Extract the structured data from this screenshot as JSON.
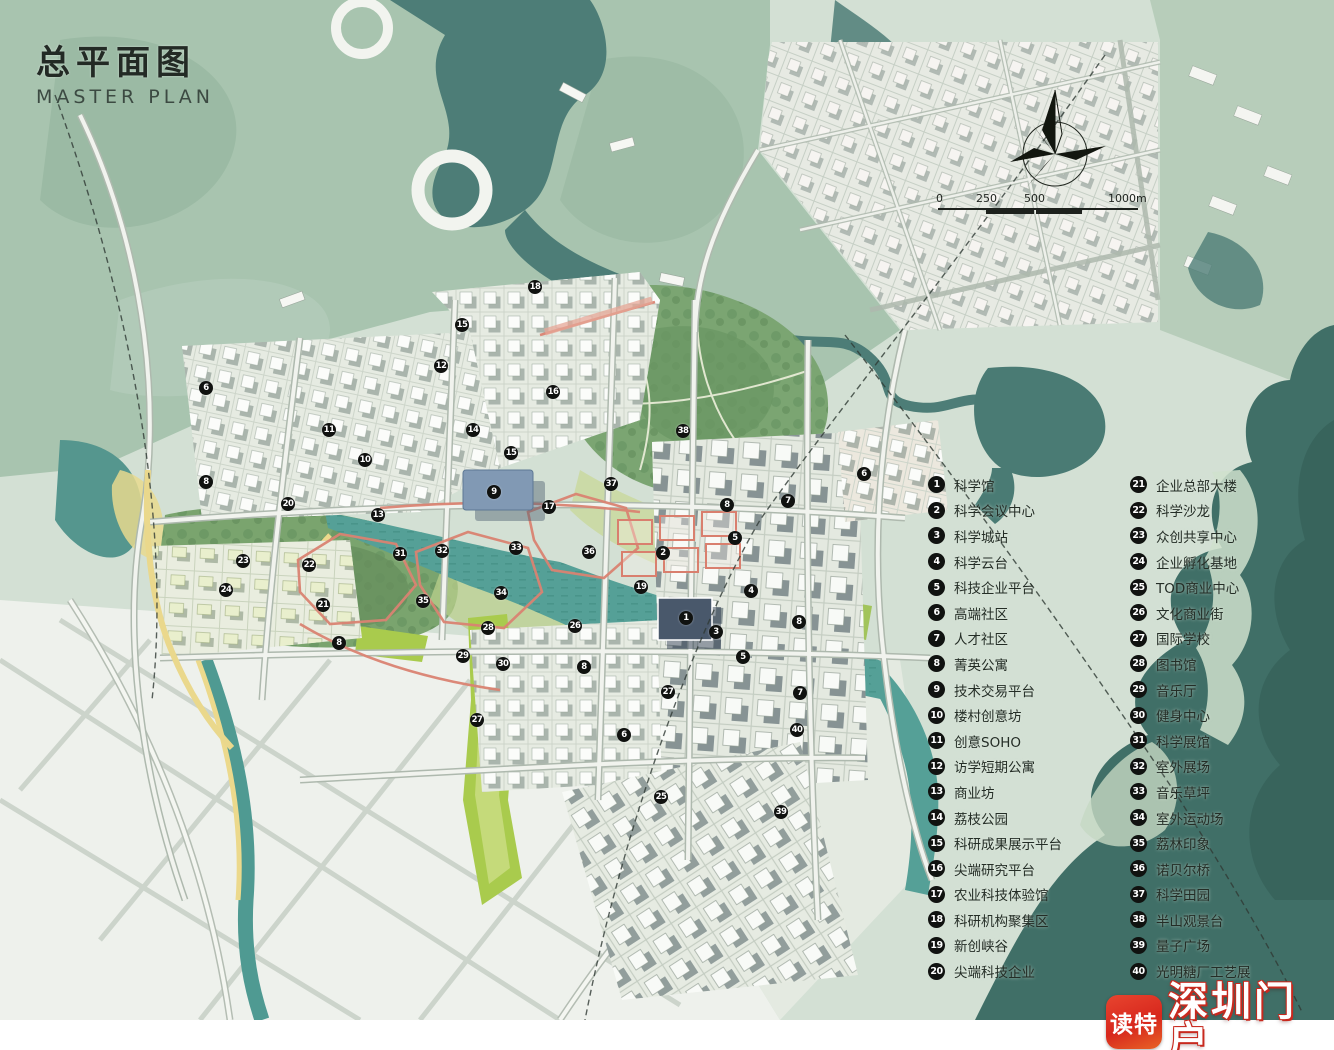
{
  "title": {
    "zh": "总平面图",
    "en": "MASTER PLAN"
  },
  "scale_bar": {
    "ticks": [
      "0",
      "250",
      "500",
      "1000m"
    ]
  },
  "legend": {
    "col1": [
      {
        "num": "1",
        "label": "科学馆"
      },
      {
        "num": "2",
        "label": "科学会议中心"
      },
      {
        "num": "3",
        "label": "科学城站"
      },
      {
        "num": "4",
        "label": "科学云台"
      },
      {
        "num": "5",
        "label": "科技企业平台"
      },
      {
        "num": "6",
        "label": "高端社区"
      },
      {
        "num": "7",
        "label": "人才社区"
      },
      {
        "num": "8",
        "label": "菁英公寓"
      },
      {
        "num": "9",
        "label": "技术交易平台"
      },
      {
        "num": "10",
        "label": "楼村创意坊"
      },
      {
        "num": "11",
        "label": "创意SOHO"
      },
      {
        "num": "12",
        "label": "访学短期公寓"
      },
      {
        "num": "13",
        "label": "商业坊"
      },
      {
        "num": "14",
        "label": "荔枝公园"
      },
      {
        "num": "15",
        "label": "科研成果展示平台"
      },
      {
        "num": "16",
        "label": "尖端研究平台"
      },
      {
        "num": "17",
        "label": "农业科技体验馆"
      },
      {
        "num": "18",
        "label": "科研机构聚集区"
      },
      {
        "num": "19",
        "label": "新创峡谷"
      },
      {
        "num": "20",
        "label": "尖端科技企业"
      }
    ],
    "col2": [
      {
        "num": "21",
        "label": "企业总部大楼"
      },
      {
        "num": "22",
        "label": "科学沙龙"
      },
      {
        "num": "23",
        "label": "众创共享中心"
      },
      {
        "num": "24",
        "label": "企业孵化基地"
      },
      {
        "num": "25",
        "label": "TOD商业中心"
      },
      {
        "num": "26",
        "label": "文化商业街"
      },
      {
        "num": "27",
        "label": "国际学校"
      },
      {
        "num": "28",
        "label": "图书馆"
      },
      {
        "num": "29",
        "label": "音乐厅"
      },
      {
        "num": "30",
        "label": "健身中心"
      },
      {
        "num": "31",
        "label": "科学展馆"
      },
      {
        "num": "32",
        "label": "室外展场"
      },
      {
        "num": "33",
        "label": "音乐草坪"
      },
      {
        "num": "34",
        "label": "室外运动场"
      },
      {
        "num": "35",
        "label": "荔林印象"
      },
      {
        "num": "36",
        "label": "诺贝尔桥"
      },
      {
        "num": "37",
        "label": "科学田园"
      },
      {
        "num": "38",
        "label": "半山观景台"
      },
      {
        "num": "39",
        "label": "量子广场"
      },
      {
        "num": "40",
        "label": "光明糖厂工艺展"
      }
    ]
  },
  "map_markers": [
    {
      "num": "18",
      "x": 535,
      "y": 287
    },
    {
      "num": "15",
      "x": 462,
      "y": 325
    },
    {
      "num": "12",
      "x": 441,
      "y": 366
    },
    {
      "num": "16",
      "x": 553,
      "y": 392
    },
    {
      "num": "6",
      "x": 206,
      "y": 388
    },
    {
      "num": "11",
      "x": 329,
      "y": 430
    },
    {
      "num": "14",
      "x": 473,
      "y": 430
    },
    {
      "num": "38",
      "x": 683,
      "y": 431
    },
    {
      "num": "15",
      "x": 511,
      "y": 453
    },
    {
      "num": "10",
      "x": 365,
      "y": 460
    },
    {
      "num": "8",
      "x": 206,
      "y": 482
    },
    {
      "num": "6",
      "x": 864,
      "y": 474
    },
    {
      "num": "9",
      "x": 494,
      "y": 492
    },
    {
      "num": "37",
      "x": 611,
      "y": 484
    },
    {
      "num": "7",
      "x": 788,
      "y": 501
    },
    {
      "num": "17",
      "x": 549,
      "y": 507
    },
    {
      "num": "8",
      "x": 727,
      "y": 505
    },
    {
      "num": "20",
      "x": 288,
      "y": 504
    },
    {
      "num": "13",
      "x": 378,
      "y": 515
    },
    {
      "num": "5",
      "x": 735,
      "y": 538
    },
    {
      "num": "33",
      "x": 516,
      "y": 548
    },
    {
      "num": "32",
      "x": 442,
      "y": 551
    },
    {
      "num": "31",
      "x": 400,
      "y": 554
    },
    {
      "num": "36",
      "x": 589,
      "y": 552
    },
    {
      "num": "2",
      "x": 663,
      "y": 553
    },
    {
      "num": "23",
      "x": 243,
      "y": 561
    },
    {
      "num": "22",
      "x": 309,
      "y": 565
    },
    {
      "num": "34",
      "x": 501,
      "y": 593
    },
    {
      "num": "4",
      "x": 751,
      "y": 591
    },
    {
      "num": "19",
      "x": 641,
      "y": 587
    },
    {
      "num": "24",
      "x": 226,
      "y": 590
    },
    {
      "num": "35",
      "x": 423,
      "y": 601
    },
    {
      "num": "21",
      "x": 323,
      "y": 605
    },
    {
      "num": "1",
      "x": 686,
      "y": 618
    },
    {
      "num": "8",
      "x": 799,
      "y": 622
    },
    {
      "num": "28",
      "x": 488,
      "y": 628
    },
    {
      "num": "26",
      "x": 575,
      "y": 626
    },
    {
      "num": "3",
      "x": 716,
      "y": 632
    },
    {
      "num": "8",
      "x": 339,
      "y": 643
    },
    {
      "num": "29",
      "x": 463,
      "y": 656
    },
    {
      "num": "30",
      "x": 503,
      "y": 664
    },
    {
      "num": "5",
      "x": 743,
      "y": 657
    },
    {
      "num": "8",
      "x": 584,
      "y": 667
    },
    {
      "num": "27",
      "x": 668,
      "y": 692
    },
    {
      "num": "7",
      "x": 800,
      "y": 693
    },
    {
      "num": "27",
      "x": 477,
      "y": 720
    },
    {
      "num": "6",
      "x": 624,
      "y": 735
    },
    {
      "num": "40",
      "x": 797,
      "y": 730
    },
    {
      "num": "25",
      "x": 661,
      "y": 797
    },
    {
      "num": "39",
      "x": 781,
      "y": 812
    }
  ],
  "watermark": {
    "app_name": "读特",
    "site_name": "深圳门户"
  },
  "colors": {
    "mountain_green": "#a8c4af",
    "valley_teal": "#4d7d77",
    "river_teal": "#57a098",
    "coast_dark": "#406f67",
    "flat_sage": "#d3e0d4",
    "city_white": "#eef1ec",
    "park_bright": "#a9cb4d",
    "forest_olive": "#7aa46e",
    "path_red": "#da8372",
    "road_yellow": "#ead88c",
    "marker_black": "#101210",
    "watermark_red": "#d7271d"
  }
}
